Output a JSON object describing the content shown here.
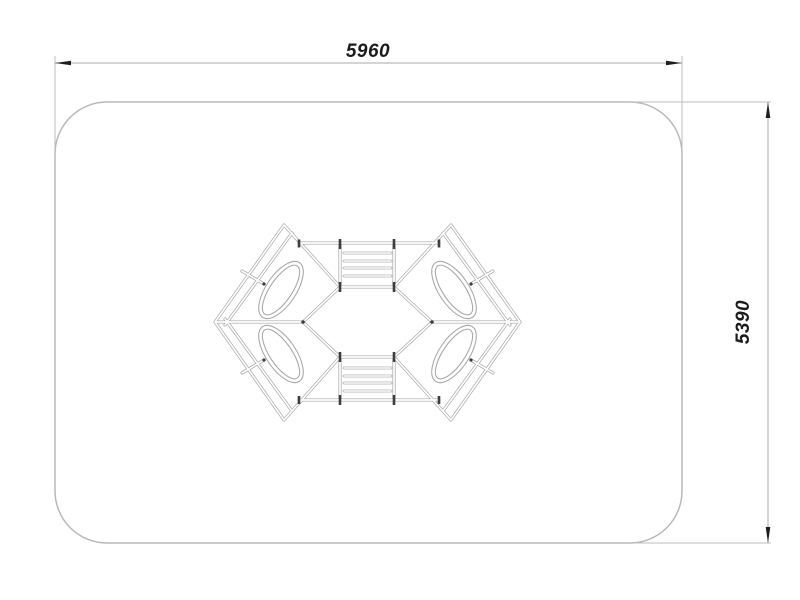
{
  "page": {
    "background": "#ffffff"
  },
  "drawing": {
    "dimensions": {
      "width_label": "5960",
      "height_label": "5390"
    },
    "colors": {
      "safety_zone_outline": "#b9b9b9",
      "structure_lines": "#a6a6a6",
      "post_marks": "#3d3d3d",
      "dimension_lines": "#a9a9a9",
      "dimension_text": "#1c1c1c"
    }
  }
}
